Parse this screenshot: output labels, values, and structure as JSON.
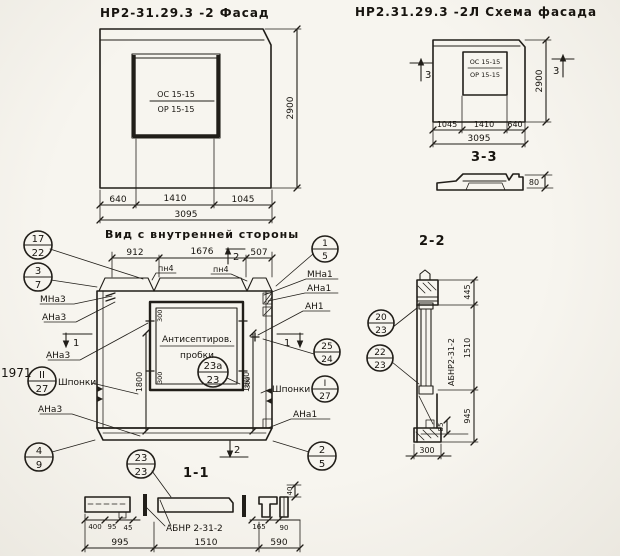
{
  "colors": {
    "paper": "#f6f4ee",
    "ink": "#211e19"
  },
  "titles": {
    "facade": "НР2-31.29.3 -2 Фасад",
    "scheme": "НР2.31.29.3 -2Л  Схема фасада",
    "inner": "Вид с внутренней стороны"
  },
  "facade": {
    "win_top": "ОС 15-15",
    "win_bot": "ОР 15-15",
    "d1": "640",
    "d2": "1410",
    "d3": "1045",
    "total": "3095",
    "height": "2900"
  },
  "scheme": {
    "win_top": "ОС 15-15",
    "win_bot": "ОР 15-15",
    "d1": "1045",
    "d2": "1410",
    "d3": "640",
    "total": "3095",
    "height": "2900",
    "mark": "3",
    "section_label": "3-3",
    "thickness": "80"
  },
  "inner": {
    "d1": "912",
    "d2": "1676",
    "d3": "507",
    "pn": "пн4",
    "sec1": "1",
    "sec2": "2",
    "h1800": "1800",
    "w300": "300",
    "plug1": "Антисептиров.",
    "plug2": "пробки",
    "keys": "Шпонки",
    "mna3": "МНа3",
    "ana3": "АНа3",
    "mna1": "МНа1",
    "ana1": "АНа1",
    "an1": "АН1",
    "stamp": "1971"
  },
  "sec11": {
    "label": "1-1",
    "beam": "АБНР 2-31-2",
    "d400": "400",
    "d95": "95",
    "d45": "45",
    "d165": "165",
    "d90": "90",
    "d995": "995",
    "d1510": "1510",
    "d590": "590",
    "d40": "40"
  },
  "sec22": {
    "label": "2-2",
    "beam": "АБНР2-31-2",
    "d445": "445",
    "d1510": "1510",
    "d945": "945",
    "d85": "85",
    "d300": "300"
  },
  "callouts": [
    {
      "top": "17",
      "bottom": "22"
    },
    {
      "top": "3",
      "bottom": "7"
    },
    {
      "top": "II",
      "bottom": "27"
    },
    {
      "top": "4",
      "bottom": "9"
    },
    {
      "top": "1",
      "bottom": "5"
    },
    {
      "top": "25",
      "bottom": "24"
    },
    {
      "top": "I",
      "bottom": "27"
    },
    {
      "top": "2",
      "bottom": "5"
    },
    {
      "top": "23а",
      "bottom": "23"
    },
    {
      "top": "23",
      "bottom": "23"
    },
    {
      "top": "20",
      "bottom": "23"
    },
    {
      "top": "22",
      "bottom": "23"
    }
  ]
}
